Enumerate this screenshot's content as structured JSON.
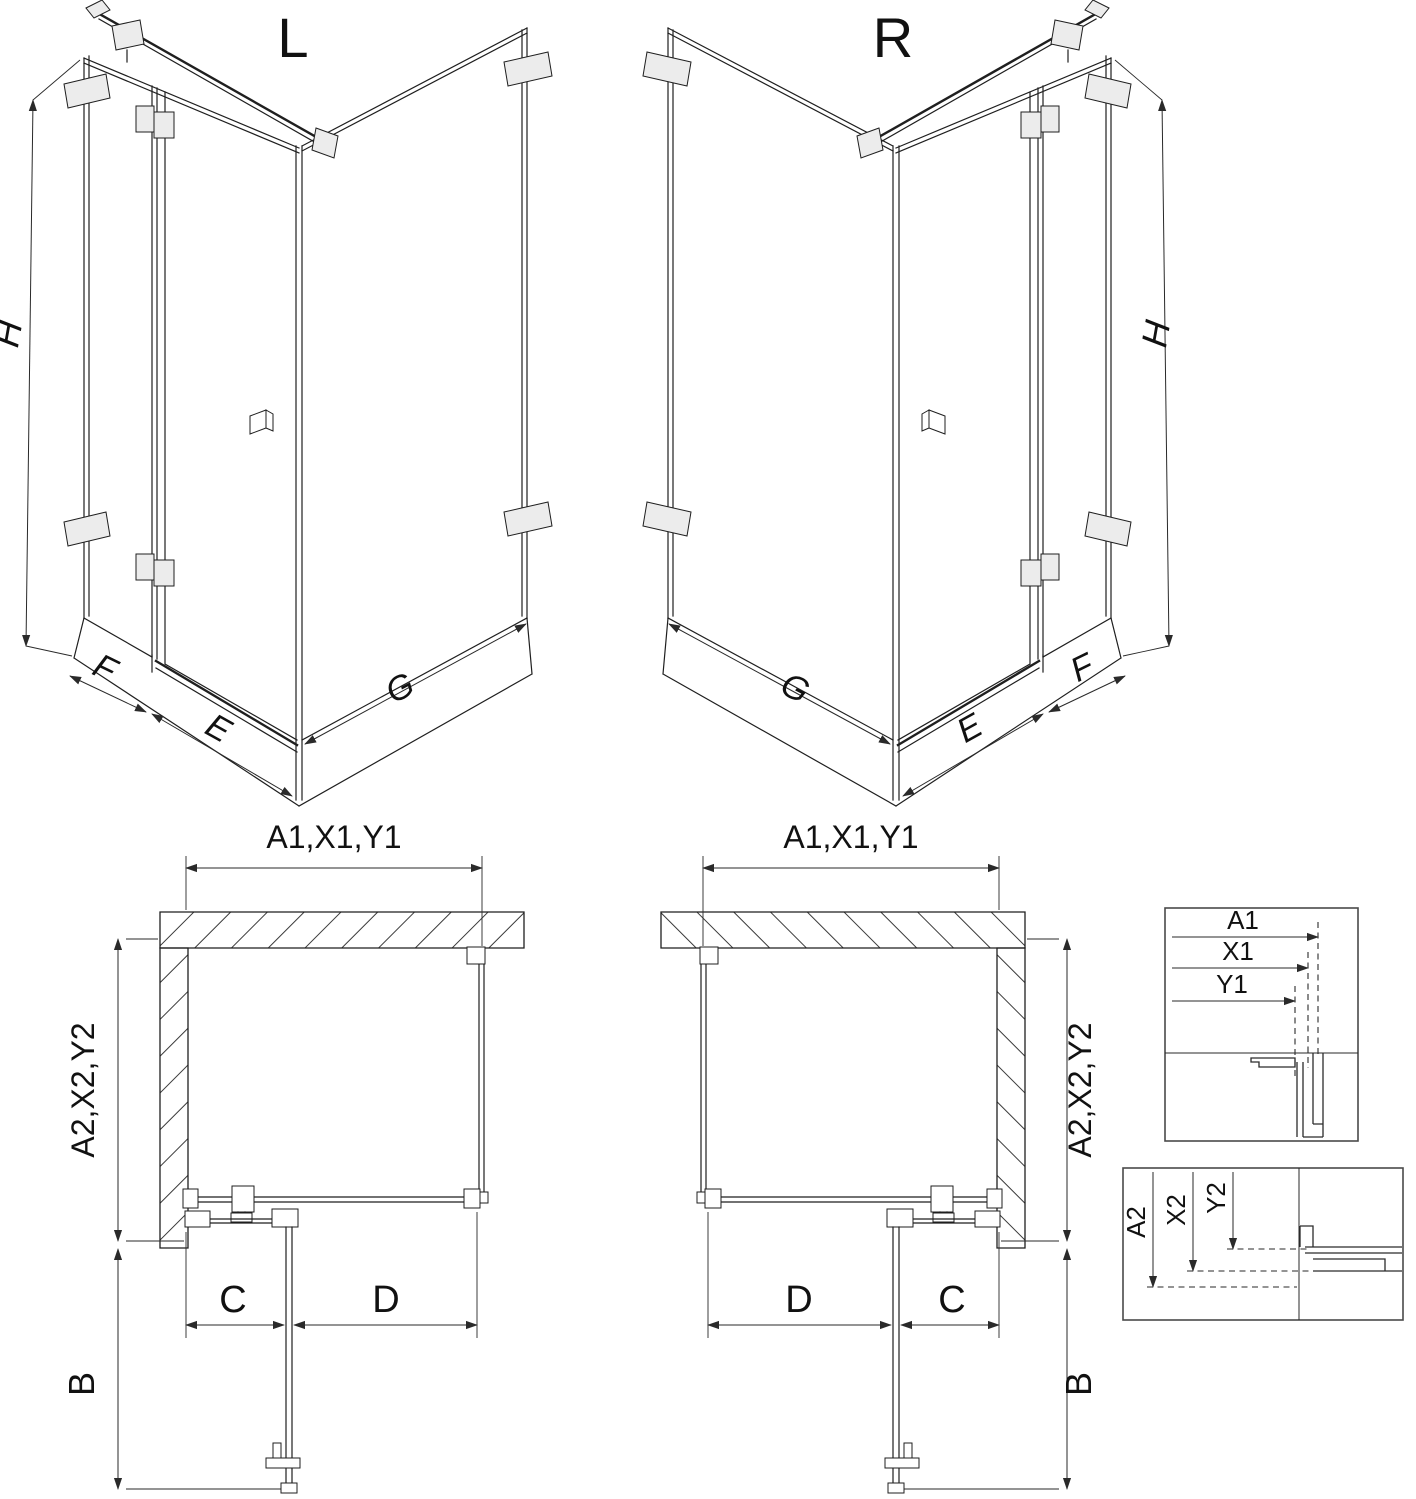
{
  "drawing": {
    "iso_left": {
      "title": "L",
      "dims": {
        "height": "H",
        "panel": "F",
        "door": "E",
        "side": "G"
      }
    },
    "iso_right": {
      "title": "R",
      "dims": {
        "height": "H",
        "panel": "F",
        "door": "E",
        "side": "G"
      }
    },
    "plan_left": {
      "width_dim": "A1,X1,Y1",
      "depth_dim": "A2,X2,Y2",
      "fixed_dim": "C",
      "door_dim": "D",
      "swing_dim": "B"
    },
    "plan_right": {
      "width_dim": "A1,X1,Y1",
      "depth_dim": "A2,X2,Y2",
      "fixed_dim": "C",
      "door_dim": "D",
      "swing_dim": "B"
    },
    "detail_width": {
      "dims": [
        "A1",
        "X1",
        "Y1"
      ]
    },
    "detail_depth": {
      "dims": [
        "A2",
        "X2",
        "Y2"
      ]
    },
    "colors": {
      "line": "#1f1f1f",
      "dim_line": "#2a2a2a",
      "hardware_fill": "#ececec",
      "background": "#ffffff"
    }
  }
}
